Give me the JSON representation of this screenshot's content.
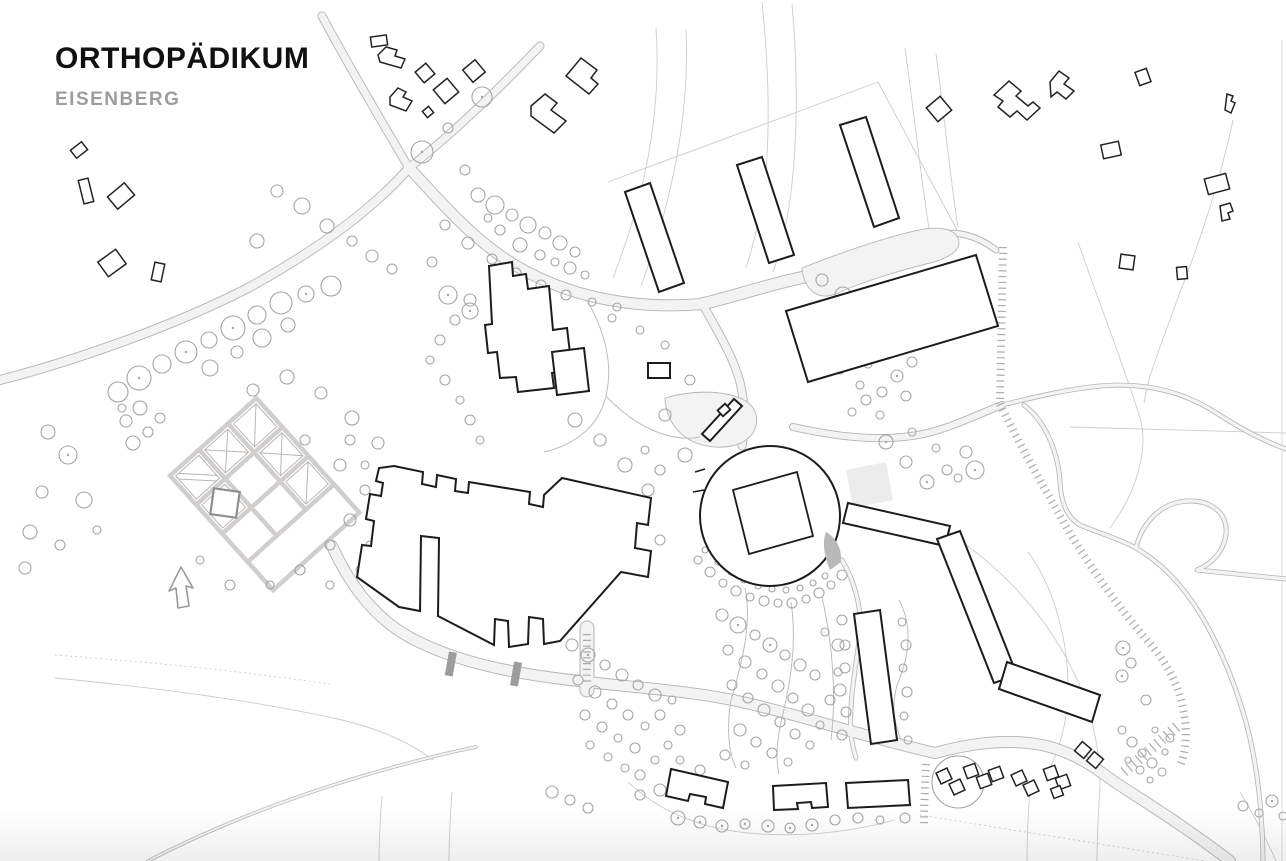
{
  "header": {
    "title": "ORTHOPÄDIKUM",
    "subtitle": "EISENBERG"
  },
  "colors": {
    "background": "#ffffff",
    "title_text": "#111111",
    "subtitle_text": "#9d9d9d",
    "building_outline": "#1c1c1c",
    "context_building_outline": "#222222",
    "road_fill": "#f3f3f3",
    "road_edge": "#b4b4b4",
    "tree_stroke": "#a5a5a5",
    "path_stroke": "#bdbdbd",
    "terrain_stroke": "#cccccc",
    "stair_tick": "#ababab",
    "ramp_fill": "#9c9c9c",
    "garden_patch": "#ececec"
  },
  "plan": {
    "type": "architectural-site-plan"
  }
}
